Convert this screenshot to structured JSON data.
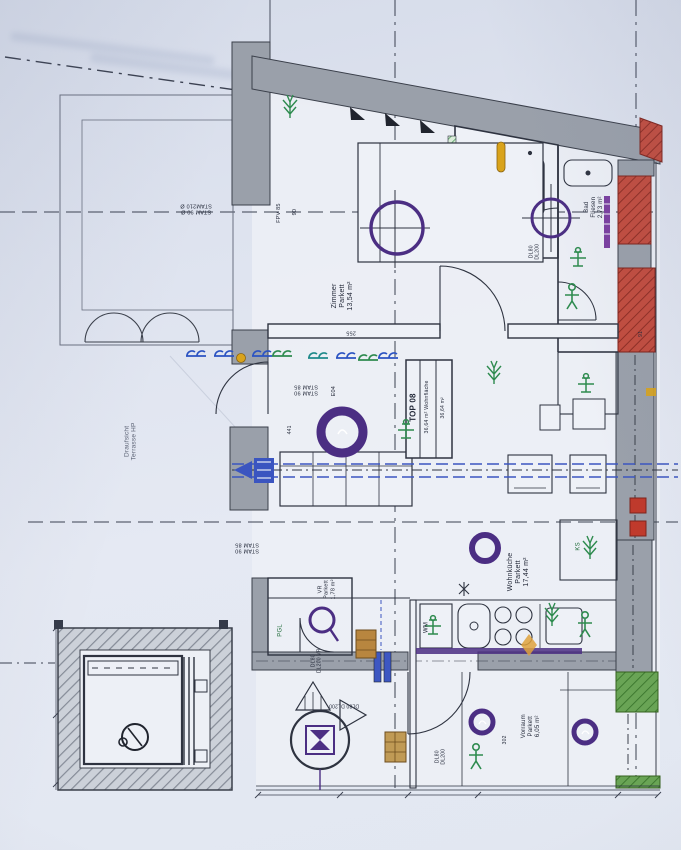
{
  "unit": {
    "id": "TOP 08",
    "col2": "36,64 m² Wohnfläche",
    "col3": "36,64 m²"
  },
  "rooms": {
    "zimmer": {
      "name": "Zimmer",
      "floor": "Parkett",
      "area": "13,54 m²"
    },
    "bad": {
      "name": "Bad",
      "floor": "Fliesen",
      "area": "2,73 m²"
    },
    "wohnkueche": {
      "name": "Wohnküche",
      "floor": "Parkett",
      "area": "17,44 m²"
    },
    "vorraum": {
      "name": "Vorraum",
      "floor": "Parkett",
      "area": "6,05 m²"
    },
    "vr": {
      "name": "VR",
      "floor": "Parkett",
      "area": "1,78 m²"
    },
    "terrasse": {
      "line1": "Draufsicht",
      "line2": "Terrasse HP"
    }
  },
  "doors": {
    "wc1": "DL80",
    "wc2": "DL200",
    "ent1": "DL80",
    "ent2": "DL200",
    "vr1": "DL80",
    "vr2": "DL200 VR",
    "ent3": "DL80 DL200"
  },
  "frames": {
    "a1": "STAM 90 Ø",
    "a2": "STAM210 Ø",
    "b1": "STAM 90",
    "b2": "STAM 85",
    "c1": "STAM 90",
    "c2": "STAM 85",
    "e04": "E04",
    "fpv": "FPV 85"
  },
  "appliances": {
    "wm": "WM",
    "ks": "KS",
    "pgl": "PGL"
  },
  "dims": {
    "n255": "255",
    "n441": "441",
    "n302": "302",
    "n91": "91",
    "n90": "90"
  },
  "colors": {
    "wall_gray": "#9aa0aa",
    "wall_red": "#c24c3e",
    "wall_green": "#69a455",
    "accent_purple": "#4b2e83",
    "beam_blue": "#3b55c0",
    "symbol_green": "#2e8b4f",
    "line_dark": "#2e3340",
    "paper": "#e2e7f1"
  }
}
